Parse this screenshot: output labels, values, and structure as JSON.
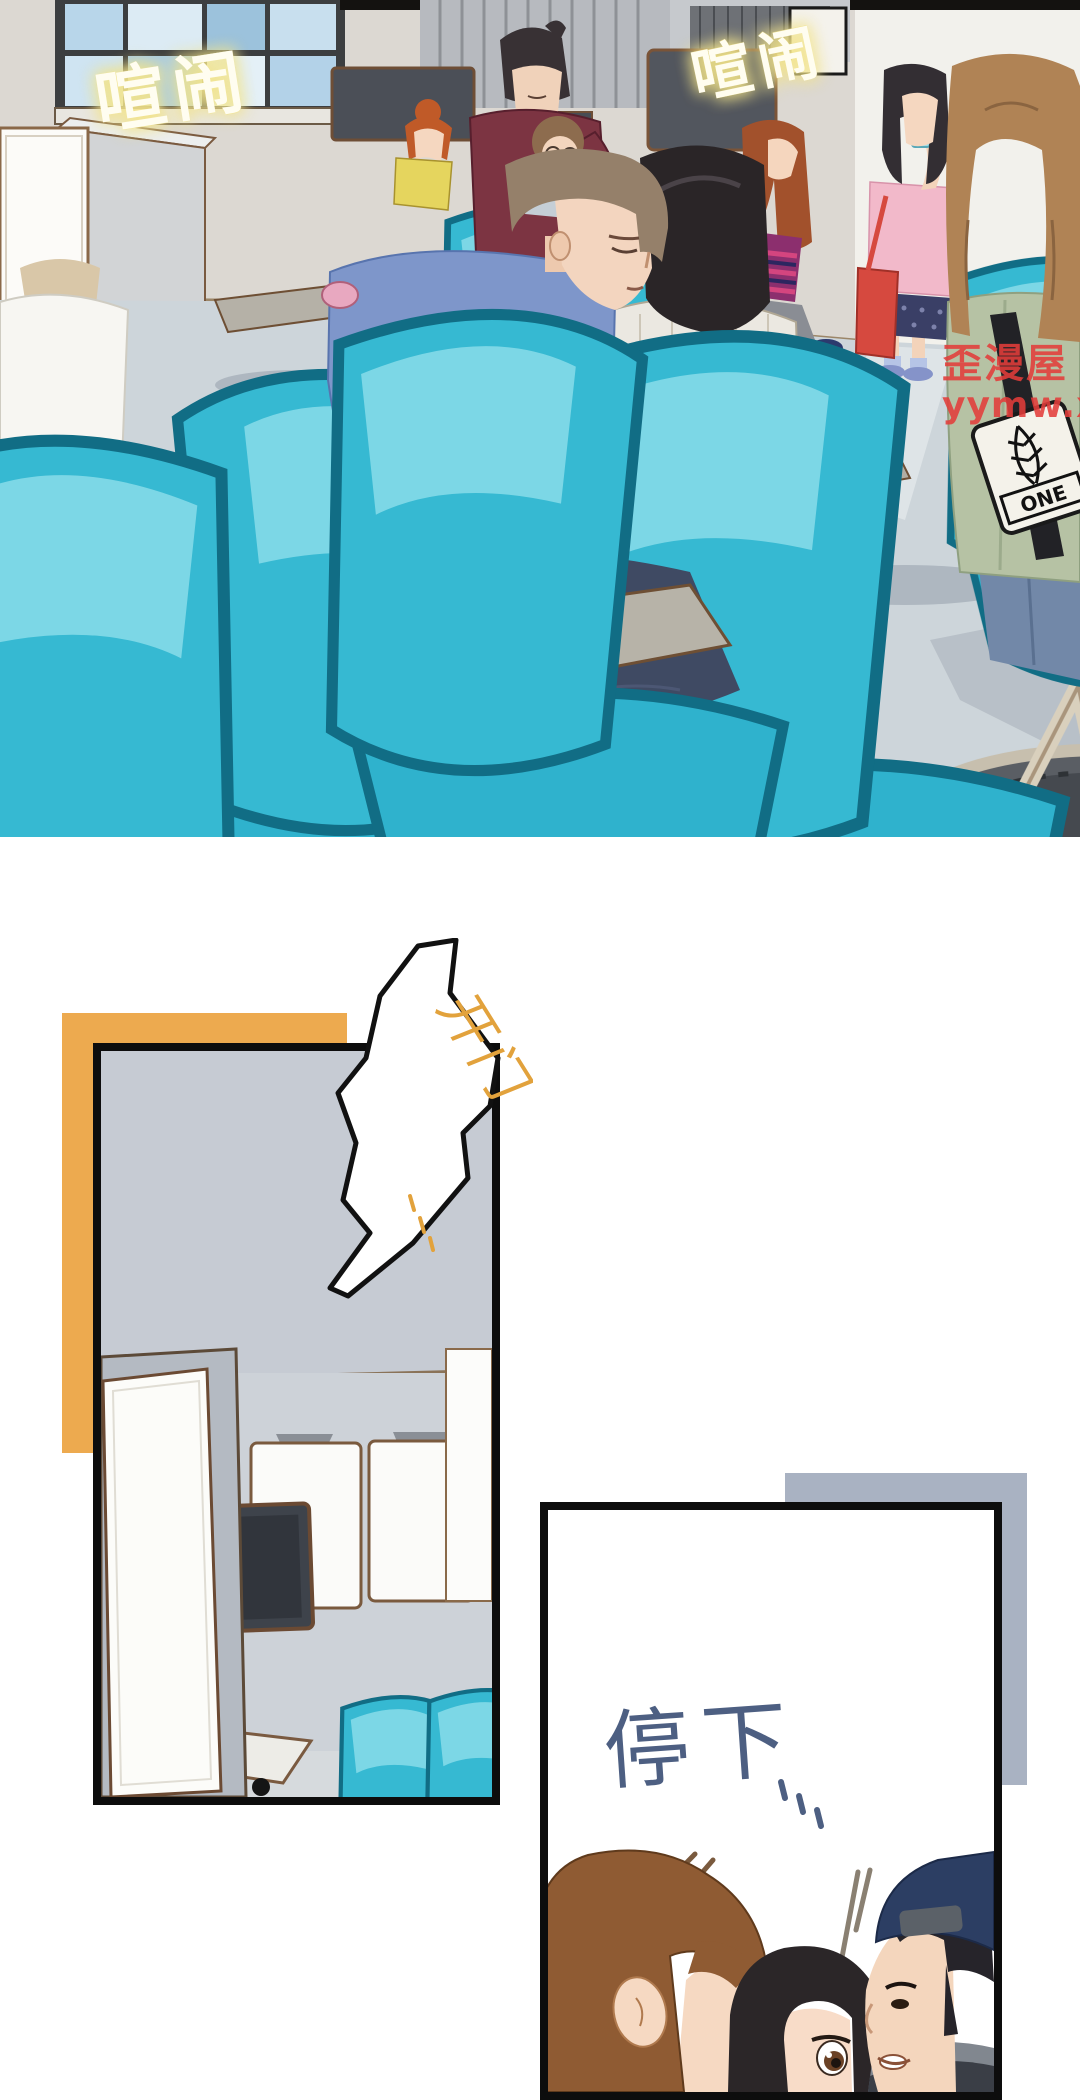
{
  "panel1": {
    "sfx_left": "喧闹",
    "sfx_right": "喧闹",
    "watermark_line1": "歪漫屋",
    "watermark_line2": "yymw.xyz",
    "bag_patch_label": "ONE"
  },
  "panel2": {
    "door_sfx": "开门"
  },
  "panel3": {
    "dialogue": "停下"
  },
  "palette": {
    "accent_orange": "#edaa4f",
    "accent_gray": "#a9b2c2",
    "chair_teal": "#2fb2cd",
    "neon_yellow": "#f2e38a",
    "watermark_red": "#e23c3a",
    "dialogue_blue": "#4d5f82",
    "sfx_orange": "#e2a23c",
    "panel_border": "#0d0d0d"
  }
}
